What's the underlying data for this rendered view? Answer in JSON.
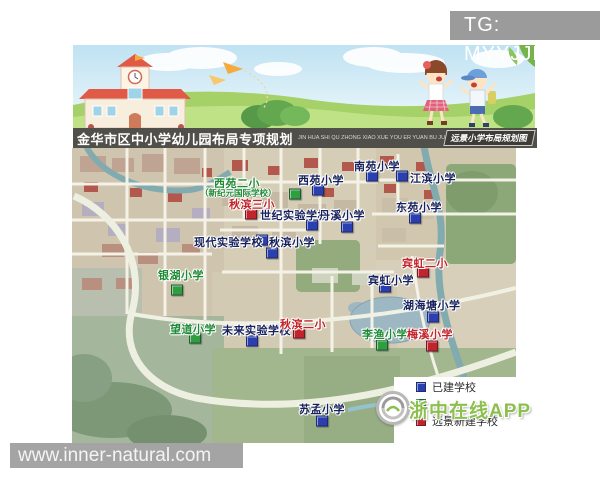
{
  "watermarks": {
    "tg": "TG: MYYJJPP",
    "site": "www.inner-natural.com",
    "app": "浙中在线APP"
  },
  "header": {
    "title": "金华市区中小学幼儿园布局专项规划",
    "pinyin": "JIN HUA SHI QU ZHONG XIAO XUE YOU ER YUAN BU JU ZHUAN XIANG GUI HUA",
    "corner_label": "远景小学布局规划图"
  },
  "colors": {
    "existing_marker": "#2a3fb0",
    "nearterm_marker": "#2f9e3f",
    "longterm_marker": "#c3232a",
    "existing_text": "#17225c",
    "nearterm_text": "#1f8a35",
    "longterm_text": "#c3232a",
    "app_watermark_green": "#8dbf4e"
  },
  "legend": {
    "items": [
      {
        "type": "existing",
        "label": "已建学校"
      },
      {
        "type": "nearterm",
        "label": ""
      },
      {
        "type": "longterm",
        "label": "远景新建学校"
      }
    ]
  },
  "map": {
    "schools": [
      {
        "name": "南苑小学",
        "type": "existing",
        "label": [
          282,
          10
        ],
        "marker": [
          300,
          28
        ]
      },
      {
        "name": "西苑小学",
        "type": "existing",
        "label": [
          226,
          24
        ],
        "marker": [
          246,
          42
        ]
      },
      {
        "name": "江滨小学",
        "type": "existing",
        "label": [
          338,
          22
        ],
        "marker": [
          330,
          28
        ]
      },
      {
        "name": "西苑二小",
        "type": "nearterm",
        "label": [
          142,
          27
        ],
        "sub": "（新纪元国际学校）",
        "sub_pos": [
          128,
          39
        ],
        "marker": [
          223,
          46
        ]
      },
      {
        "name": "秋滨三小",
        "type": "longterm",
        "label": [
          157,
          48
        ],
        "marker": [
          179,
          66
        ]
      },
      {
        "name": "世纪实验学校",
        "type": "existing",
        "label": [
          188,
          59
        ],
        "marker": [
          240,
          77
        ]
      },
      {
        "name": "丹溪小学",
        "type": "existing",
        "label": [
          247,
          59
        ],
        "marker": [
          275,
          79
        ]
      },
      {
        "name": "东苑小学",
        "type": "existing",
        "label": [
          324,
          51
        ],
        "marker": [
          343,
          70
        ]
      },
      {
        "name": "现代实验学校",
        "type": "existing",
        "label": [
          122,
          86
        ],
        "marker": [
          190,
          92
        ]
      },
      {
        "name": "秋滨小学",
        "type": "existing",
        "label": [
          197,
          86
        ],
        "marker": [
          200,
          105
        ]
      },
      {
        "name": "宾虹二小",
        "type": "longterm",
        "label": [
          330,
          107
        ],
        "marker": [
          351,
          124
        ]
      },
      {
        "name": "银湖小学",
        "type": "nearterm",
        "label": [
          86,
          119
        ],
        "marker": [
          105,
          142
        ]
      },
      {
        "name": "宾虹小学",
        "type": "existing",
        "label": [
          296,
          124
        ],
        "marker": [
          313,
          139
        ]
      },
      {
        "name": "湖海塘小学",
        "type": "existing",
        "label": [
          331,
          149
        ],
        "marker": [
          361,
          169
        ]
      },
      {
        "name": "望道小学",
        "type": "nearterm",
        "label": [
          98,
          173
        ],
        "marker": [
          123,
          190
        ]
      },
      {
        "name": "未来实验学校",
        "type": "existing",
        "label": [
          150,
          174
        ],
        "marker": [
          180,
          193
        ]
      },
      {
        "name": "秋滨二小",
        "type": "longterm",
        "label": [
          208,
          168
        ],
        "marker": [
          227,
          185
        ]
      },
      {
        "name": "李渔小学",
        "type": "nearterm",
        "label": [
          290,
          178
        ],
        "marker": [
          310,
          197
        ]
      },
      {
        "name": "梅溪小学",
        "type": "longterm",
        "label": [
          335,
          178
        ],
        "marker": [
          360,
          198
        ]
      },
      {
        "name": "苏孟小学",
        "type": "existing",
        "label": [
          227,
          253
        ],
        "marker": [
          250,
          273
        ]
      }
    ]
  }
}
